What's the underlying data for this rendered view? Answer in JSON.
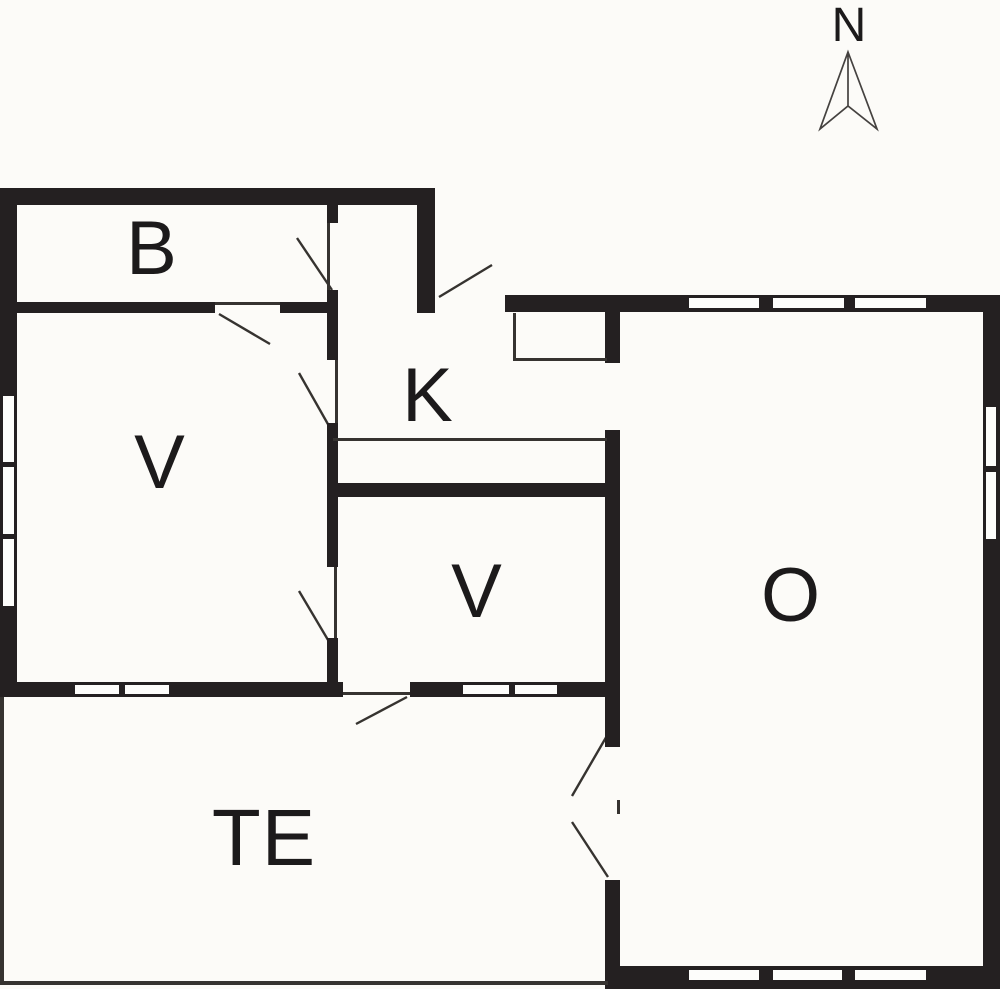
{
  "canvas": {
    "width": 1000,
    "height": 989
  },
  "colors": {
    "background": "#ffffff",
    "floor": "#fcfbf8",
    "wall": "#242021",
    "thin_line": "#363330",
    "window_fill": "#fdfdfb",
    "label": "#1c1a1b",
    "compass_outline": "#454240"
  },
  "compass": {
    "label": "N",
    "label_x": 849,
    "label_y": 26,
    "label_size": 48,
    "arrow": {
      "apex": [
        848,
        52
      ],
      "right": [
        877,
        129
      ],
      "notch": [
        848,
        106
      ],
      "left": [
        820,
        129
      ]
    }
  },
  "room_labels": [
    {
      "id": "b",
      "text": "B",
      "x": 152,
      "y": 249,
      "size": 76
    },
    {
      "id": "v-west",
      "text": "V",
      "x": 160,
      "y": 463,
      "size": 76
    },
    {
      "id": "k",
      "text": "K",
      "x": 428,
      "y": 396,
      "size": 76
    },
    {
      "id": "v-middle",
      "text": "V",
      "x": 477,
      "y": 592,
      "size": 76
    },
    {
      "id": "o",
      "text": "O",
      "x": 791,
      "y": 596,
      "size": 76
    },
    {
      "id": "te",
      "text": "TE",
      "x": 264,
      "y": 838,
      "size": 80
    }
  ],
  "walls": [
    {
      "name": "top-wall",
      "x": 0,
      "y": 188,
      "w": 435,
      "h": 17
    },
    {
      "name": "west-wall",
      "x": 0,
      "y": 205,
      "w": 17,
      "h": 492
    },
    {
      "name": "b-south-wall-west",
      "x": 0,
      "y": 302,
      "w": 215,
      "h": 11
    },
    {
      "name": "b-south-wall-east",
      "x": 280,
      "y": 302,
      "w": 58,
      "h": 11
    },
    {
      "name": "b-east-wall-upper",
      "x": 327,
      "y": 205,
      "w": 11,
      "h": 18
    },
    {
      "name": "mid-wall-cross",
      "x": 327,
      "y": 290,
      "w": 11,
      "h": 70
    },
    {
      "name": "vestibule-east-wall",
      "x": 417,
      "y": 205,
      "w": 18,
      "h": 108
    },
    {
      "name": "mid-wall-center",
      "x": 327,
      "y": 423,
      "w": 11,
      "h": 144
    },
    {
      "name": "mid-wall-lower",
      "x": 327,
      "y": 638,
      "w": 11,
      "h": 59
    },
    {
      "name": "v2-north-wall",
      "x": 327,
      "y": 483,
      "w": 293,
      "h": 14
    },
    {
      "name": "closet-east-bar",
      "x": 605,
      "y": 295,
      "w": 15,
      "h": 68
    },
    {
      "name": "o-west-wall-upper",
      "x": 605,
      "y": 430,
      "w": 15,
      "h": 317
    },
    {
      "name": "o-west-wall-lower",
      "x": 605,
      "y": 880,
      "w": 15,
      "h": 109
    },
    {
      "name": "o-north-wall",
      "x": 505,
      "y": 295,
      "w": 495,
      "h": 17
    },
    {
      "name": "o-east-wall",
      "x": 983,
      "y": 312,
      "w": 17,
      "h": 677
    },
    {
      "name": "o-south-wall",
      "x": 605,
      "y": 966,
      "w": 395,
      "h": 23
    },
    {
      "name": "te-north-wall-west",
      "x": 0,
      "y": 682,
      "w": 343,
      "h": 15
    },
    {
      "name": "te-north-wall-east",
      "x": 410,
      "y": 682,
      "w": 210,
      "h": 15
    }
  ],
  "thin_lines": [
    {
      "name": "kitchen-counter-line",
      "x": 333,
      "y": 438,
      "w": 274,
      "h": 3
    },
    {
      "name": "closet-west-edge",
      "x": 513,
      "y": 313,
      "w": 3,
      "h": 48
    },
    {
      "name": "closet-south-edge",
      "x": 513,
      "y": 358,
      "w": 94,
      "h": 3
    },
    {
      "name": "terrace-west-edge",
      "x": 0,
      "y": 697,
      "w": 4,
      "h": 288
    },
    {
      "name": "terrace-south-edge",
      "x": 0,
      "y": 981,
      "w": 608,
      "h": 4
    },
    {
      "name": "b-south-door-header",
      "x": 215,
      "y": 302,
      "w": 65,
      "h": 3
    },
    {
      "name": "b-east-door-header",
      "x": 327,
      "y": 223,
      "w": 3,
      "h": 67
    },
    {
      "name": "v-k-door-header",
      "x": 335,
      "y": 360,
      "w": 3,
      "h": 63
    },
    {
      "name": "v-v2-door-header",
      "x": 334,
      "y": 567,
      "w": 3,
      "h": 71
    },
    {
      "name": "v2-te-door-sill",
      "x": 343,
      "y": 692,
      "w": 67,
      "h": 3
    },
    {
      "name": "o-te-door-meeting-mark",
      "x": 617,
      "y": 800,
      "w": 3,
      "h": 14
    }
  ],
  "windows": [
    {
      "name": "west-window-1",
      "x": 2,
      "y": 395,
      "w": 13,
      "h": 68
    },
    {
      "name": "west-window-2",
      "x": 2,
      "y": 466,
      "w": 13,
      "h": 69
    },
    {
      "name": "west-window-3",
      "x": 2,
      "y": 538,
      "w": 13,
      "h": 69
    },
    {
      "name": "v-south-window-1",
      "x": 74,
      "y": 684,
      "w": 46,
      "h": 11
    },
    {
      "name": "v-south-window-2",
      "x": 124,
      "y": 684,
      "w": 46,
      "h": 11
    },
    {
      "name": "v2-south-window-1",
      "x": 462,
      "y": 684,
      "w": 48,
      "h": 11
    },
    {
      "name": "v2-south-window-2",
      "x": 514,
      "y": 684,
      "w": 44,
      "h": 11
    },
    {
      "name": "o-north-window-1",
      "x": 688,
      "y": 297,
      "w": 72,
      "h": 12
    },
    {
      "name": "o-north-window-2",
      "x": 772,
      "y": 297,
      "w": 73,
      "h": 12
    },
    {
      "name": "o-north-window-3",
      "x": 854,
      "y": 297,
      "w": 73,
      "h": 12
    },
    {
      "name": "o-east-window-1",
      "x": 985,
      "y": 406,
      "w": 12,
      "h": 61
    },
    {
      "name": "o-east-window-2",
      "x": 985,
      "y": 471,
      "w": 12,
      "h": 69
    },
    {
      "name": "o-south-window-1",
      "x": 688,
      "y": 969,
      "w": 72,
      "h": 12
    },
    {
      "name": "o-south-window-2",
      "x": 772,
      "y": 969,
      "w": 71,
      "h": 12
    },
    {
      "name": "o-south-window-3",
      "x": 854,
      "y": 969,
      "w": 73,
      "h": 12
    }
  ],
  "door_swings": [
    {
      "name": "b-east-door-swing",
      "x1": 297,
      "y1": 238,
      "x2": 332,
      "y2": 290
    },
    {
      "name": "b-south-door-swing",
      "x1": 219,
      "y1": 314,
      "x2": 270,
      "y2": 344
    },
    {
      "name": "v-k-door-swing",
      "x1": 299,
      "y1": 373,
      "x2": 329,
      "y2": 426
    },
    {
      "name": "v-v2-door-swing",
      "x1": 299,
      "y1": 591,
      "x2": 331,
      "y2": 645
    },
    {
      "name": "v2-te-door-swing",
      "x1": 407,
      "y1": 697,
      "x2": 356,
      "y2": 724
    },
    {
      "name": "entrance-door-swing",
      "x1": 439,
      "y1": 297,
      "x2": 492,
      "y2": 265
    },
    {
      "name": "o-te-door-swing-top",
      "x1": 608,
      "y1": 734,
      "x2": 572,
      "y2": 796
    },
    {
      "name": "o-te-door-swing-bottom",
      "x1": 572,
      "y1": 822,
      "x2": 608,
      "y2": 877
    }
  ]
}
